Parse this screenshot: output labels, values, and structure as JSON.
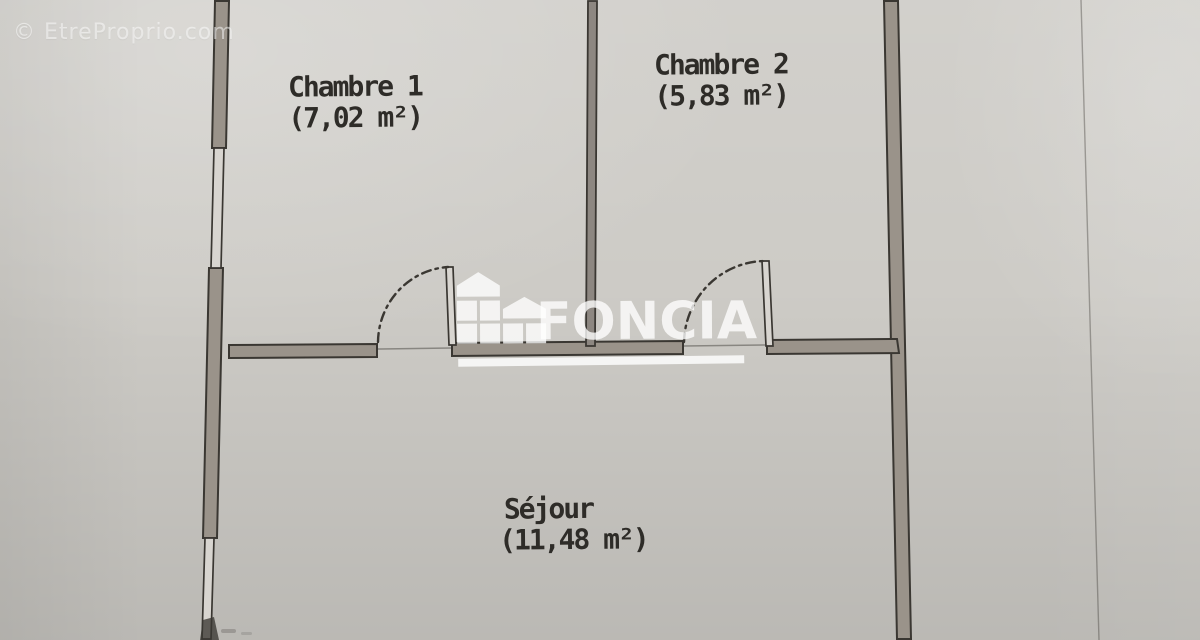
{
  "watermarks": {
    "corner": "© EtreProprio.com",
    "brand": "FONCIA"
  },
  "rooms": [
    {
      "name": "Chambre 1",
      "area": "(7,02 m²)"
    },
    {
      "name": "Chambre 2",
      "area": "(5,83 m²)"
    },
    {
      "name": "Séjour",
      "area": "(11,48 m²)"
    }
  ],
  "colors": {
    "paper": "#cdcbc6",
    "wall_fill": "#9a938a",
    "wall_fill_dark": "#8d8781",
    "window_fill": "#d8d5d0",
    "line": "#3a3732",
    "label_text": "#2e2c28",
    "watermark_white": "rgba(255,255,255,0.78)",
    "watermark_underline": "rgba(255,255,255,0.82)",
    "watermark_corner": "rgba(255,255,255,0.5)"
  }
}
